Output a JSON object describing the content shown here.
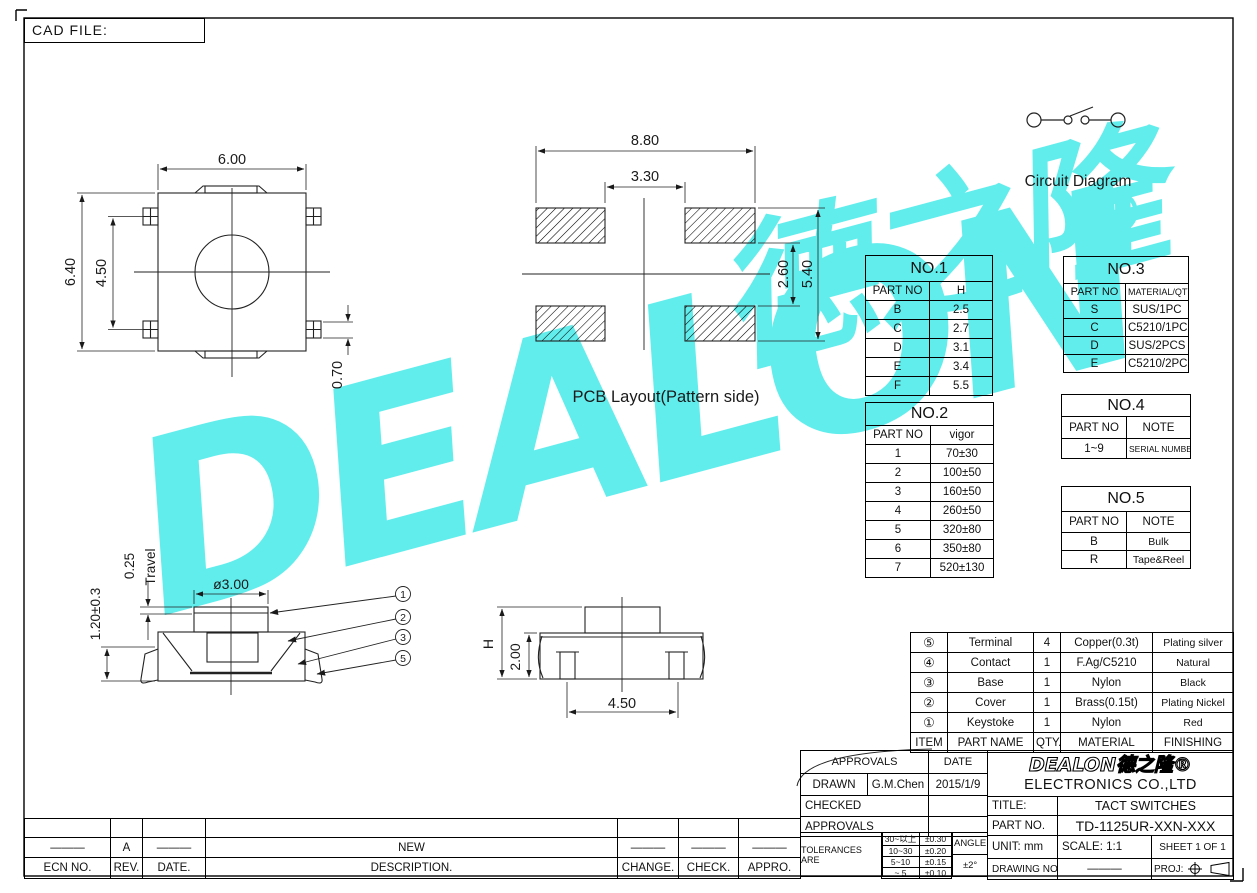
{
  "meta": {
    "cad_file": "CAD FILE:"
  },
  "watermark": {
    "latin": "DEALON",
    "cn": "德之隆",
    "reg": "®",
    "color": "#62eded"
  },
  "top_view": {
    "dim_width": "6.00",
    "dim_height": "6.40",
    "dim_inner": "4.50",
    "dim_lead": "0.70"
  },
  "pcb_view": {
    "caption": "PCB Layout(Pattern side)",
    "dim_outer": "8.80",
    "dim_inner": "3.30",
    "dim_pad_gap": "2.60",
    "dim_pad_outer": "5.40"
  },
  "circuit": {
    "caption": "Circuit Diagram"
  },
  "side_front": {
    "dim_travel": "0.25",
    "travel_label": "Travel",
    "dim_stem": "ø3.00",
    "dim_height": "1.20±0.3",
    "balloons": [
      "1",
      "2",
      "3",
      "5"
    ]
  },
  "side_right": {
    "dim_h": "H",
    "dim_body": "2.00",
    "dim_pitch": "4.50"
  },
  "tables": {
    "no1": {
      "title": "NO.1",
      "headers": [
        "PART NO",
        "H"
      ],
      "rows": [
        [
          "B",
          "2.5"
        ],
        [
          "C",
          "2.7"
        ],
        [
          "D",
          "3.1"
        ],
        [
          "E",
          "3.4"
        ],
        [
          "F",
          "5.5"
        ]
      ]
    },
    "no2": {
      "title": "NO.2",
      "headers": [
        "PART NO",
        "vigor"
      ],
      "rows": [
        [
          "1",
          "70±30"
        ],
        [
          "2",
          "100±50"
        ],
        [
          "3",
          "160±50"
        ],
        [
          "4",
          "260±50"
        ],
        [
          "5",
          "320±80"
        ],
        [
          "6",
          "350±80"
        ],
        [
          "7",
          "520±130"
        ]
      ]
    },
    "no3": {
      "title": "NO.3",
      "headers": [
        "PART NO",
        "MATERIAL/QTY"
      ],
      "rows": [
        [
          "S",
          "SUS/1PC"
        ],
        [
          "C",
          "C5210/1PC"
        ],
        [
          "D",
          "SUS/2PCS"
        ],
        [
          "E",
          "C5210/2PCS"
        ]
      ]
    },
    "no4": {
      "title": "NO.4",
      "headers": [
        "PART NO",
        "NOTE"
      ],
      "rows": [
        [
          "1~9",
          "SERIAL NUMBER"
        ]
      ]
    },
    "no5": {
      "title": "NO.5",
      "headers": [
        "PART NO",
        "NOTE"
      ],
      "rows": [
        [
          "B",
          "Bulk"
        ],
        [
          "R",
          "Tape&Reel"
        ]
      ]
    },
    "parts": {
      "headers": [
        "ITEM",
        "PART NAME",
        "QTY.",
        "MATERIAL",
        "FINISHING"
      ],
      "rows": [
        [
          "⑤",
          "Terminal",
          "4",
          "Copper(0.3t)",
          "Plating silver"
        ],
        [
          "④",
          "Contact",
          "1",
          "F.Ag/C5210",
          "Natural"
        ],
        [
          "③",
          "Base",
          "1",
          "Nylon",
          "Black"
        ],
        [
          "②",
          "Cover",
          "1",
          "Brass(0.15t)",
          "Plating Nickel"
        ],
        [
          "①",
          "Keystoke",
          "1",
          "Nylon",
          "Red"
        ]
      ]
    }
  },
  "title_block": {
    "approvals": {
      "header": "APPROVALS",
      "date_header": "DATE",
      "drawn_label": "DRAWN",
      "drawn_by": "G.M.Chen",
      "drawn_date": "2015/1/9",
      "checked_label": "CHECKED",
      "approvals_label": "APPROVALS"
    },
    "tolerances": {
      "label": "TOLERANCES ARE",
      "rows": [
        [
          "30~以上",
          "±0.30"
        ],
        [
          "10~30",
          "±0.20"
        ],
        [
          "5~10",
          "±0.15"
        ],
        [
          "~ 5",
          "±0.10"
        ]
      ],
      "angle_label": "ANGLE",
      "angle_value": "±2°"
    },
    "company": {
      "logo": "DEALON德之隆®",
      "name": "ELECTRONICS CO.,LTD"
    },
    "title_label": "TITLE:",
    "title_value": "TACT SWITCHES",
    "part_label": "PART NO.",
    "part_value": "TD-1125UR-XXN-XXX",
    "unit": "UNIT: mm",
    "scale": "SCALE: 1:1",
    "sheet": "SHEET 1 OF 1",
    "drawing_label": "DRAWING NO.",
    "drawing_value": "———",
    "proj_label": "PROJ:"
  },
  "revision": {
    "headers": [
      "ECN NO.",
      "REV.",
      "DATE.",
      "DESCRIPTION.",
      "CHANGE.",
      "CHECK.",
      "APPRO."
    ],
    "rows": [
      [
        "———",
        "A",
        "———",
        "NEW",
        "———",
        "———",
        "———"
      ]
    ]
  }
}
